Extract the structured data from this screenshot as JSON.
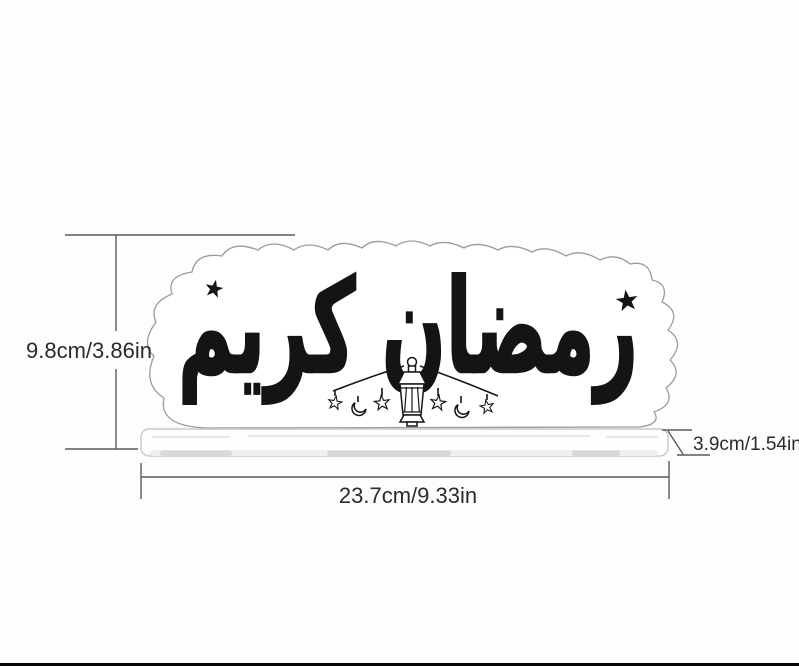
{
  "diagram": {
    "title": "Ramadan Kareem acrylic sign dimension diagram",
    "artwork": {
      "calligraphy": "رمضان كريم",
      "motifs": [
        "stars",
        "crescent-moons",
        "hanging-lantern-garland"
      ]
    },
    "dimensions": {
      "height": "9.8cm/3.86in",
      "width": "23.7cm/9.33in",
      "depth": "3.9cm/1.54in"
    },
    "colors": {
      "ink": "#141414",
      "plaque_outline": "#9c9c9c",
      "dimension_line": "#5a5a5a",
      "label_text": "#2b2b2b",
      "background": "#fdfdfb"
    }
  }
}
